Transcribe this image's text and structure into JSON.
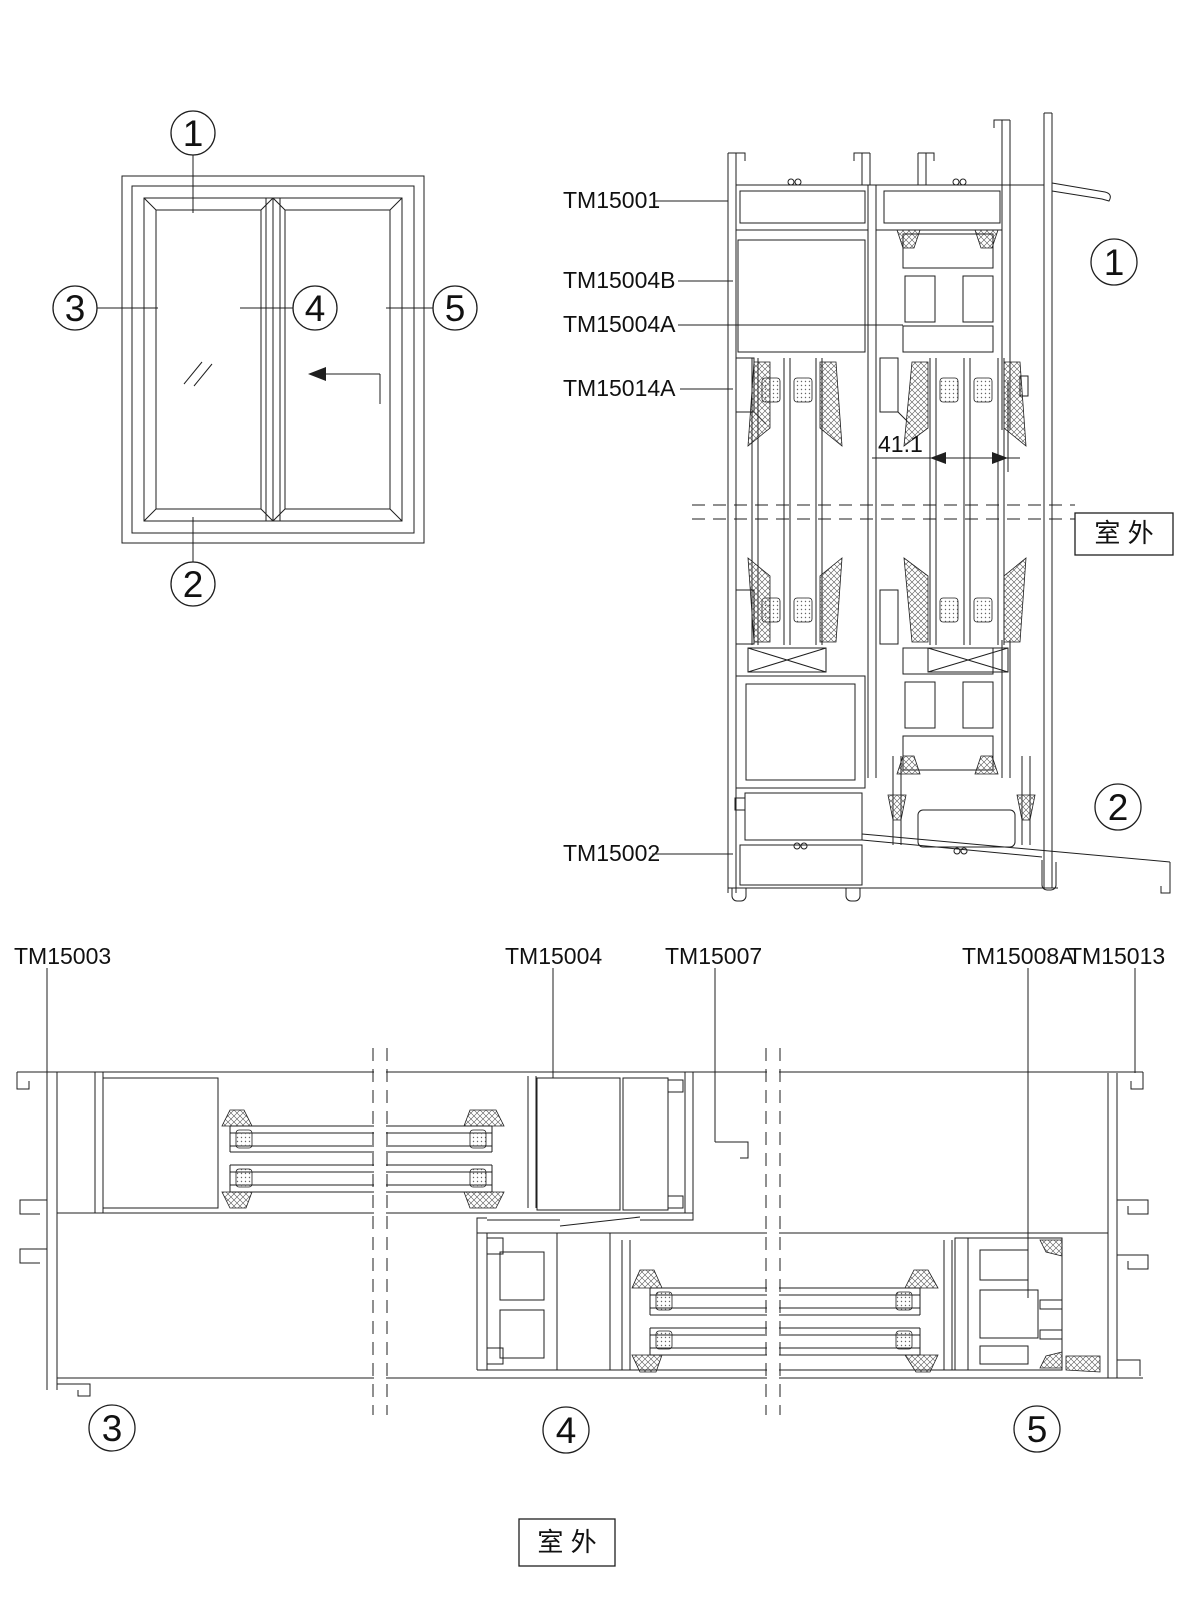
{
  "colors": {
    "line": "#1f1f1f",
    "background": "#ffffff"
  },
  "elevation": {
    "callouts": [
      "1",
      "2",
      "3",
      "4",
      "5"
    ]
  },
  "vertical_section": {
    "labels": [
      "TM15001",
      "TM15004B",
      "TM15004A",
      "TM15014A",
      "TM15002"
    ],
    "dimension": "41.1",
    "callouts": [
      "1",
      "2"
    ],
    "outdoor": "室 外"
  },
  "horizontal_section": {
    "labels": [
      "TM15003",
      "TM15004",
      "TM15007",
      "TM15008A",
      "TM15013"
    ],
    "callouts": [
      "3",
      "4",
      "5"
    ],
    "outdoor": "室 外"
  }
}
